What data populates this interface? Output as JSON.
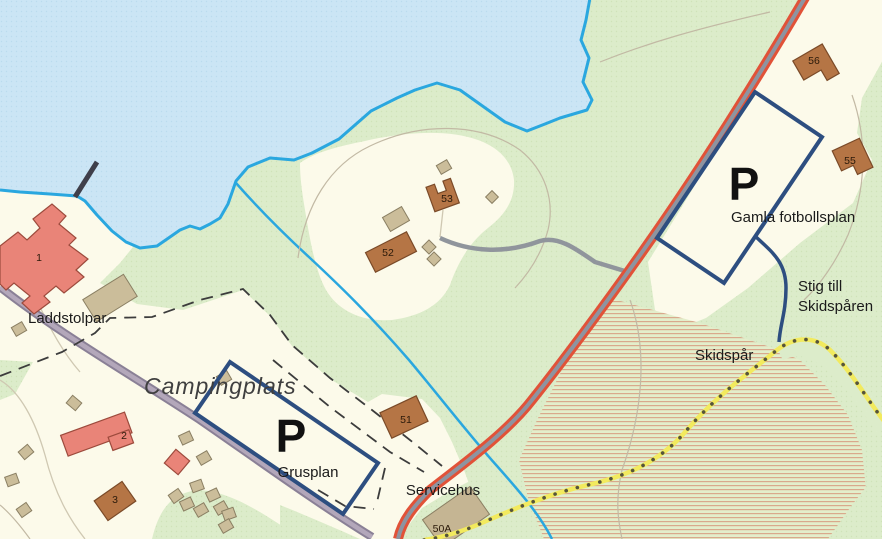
{
  "map": {
    "labels": {
      "laddstolpar": "Laddstolpar",
      "campingplats": "Campingplats",
      "parking_symbol": "P",
      "grusplan": "Grusplan",
      "servicehus": "Servicehus",
      "gamla_fotbollsplan": "Gamla fotbollsplan",
      "stig_line1": "Stig till",
      "stig_line2": "Skidspåren",
      "skidspar": "Skidspår"
    },
    "building_numbers": {
      "b1": "1",
      "b2": "2",
      "b3": "3",
      "b50a": "50A",
      "b51": "51",
      "b52": "52",
      "b53": "53",
      "b55": "55",
      "b56": "56"
    },
    "colors": {
      "water": "#cbe5f5",
      "shoreline": "#2aa7df",
      "open_land": "#fcfaea",
      "forest": "#dcecca",
      "field_hatch_line": "#d9a98c",
      "road_main": "#e15238",
      "road_center": "#8e94a0",
      "road_secondary": "#a79db0",
      "parking_outline": "#2d4e80",
      "ski_trail_yellow": "#f2ea5e",
      "ski_trail_dot": "#56543c",
      "building_red": "#e98478",
      "building_brown": "#b57545",
      "building_tan": "#cbbd9a"
    }
  }
}
